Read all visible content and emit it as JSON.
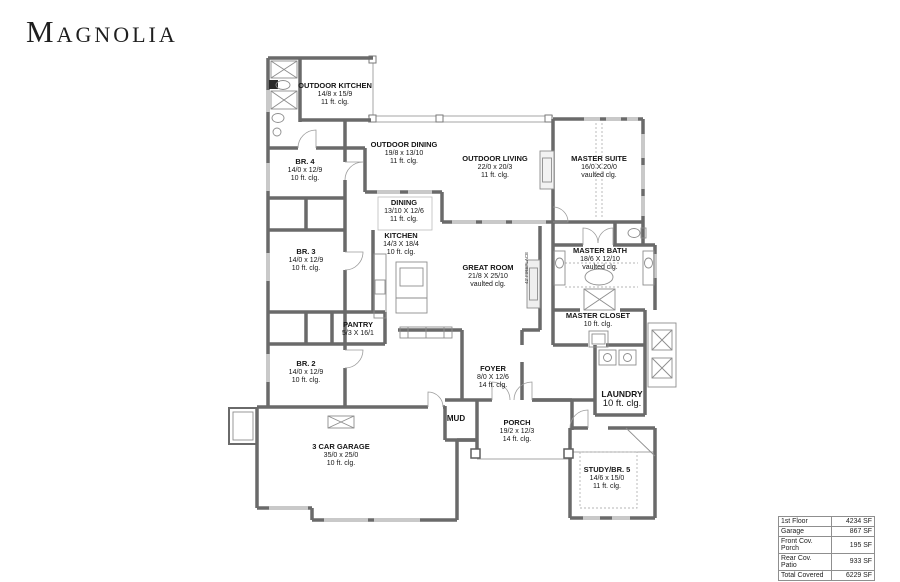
{
  "title": "Magnolia",
  "rooms": {
    "outdoor_kitchen": {
      "name": "OUTDOOR KITCHEN",
      "dims": "14/8 x 15/9",
      "ceiling": "11 ft. clg."
    },
    "outdoor_dining": {
      "name": "OUTDOOR DINING",
      "dims": "19/8 x 13/10",
      "ceiling": "11 ft. clg."
    },
    "outdoor_living": {
      "name": "OUTDOOR LIVING",
      "dims": "22/0 x 20/3",
      "ceiling": "11 ft. clg."
    },
    "master_suite": {
      "name": "MASTER SUITE",
      "dims": "16/0 X 20/0",
      "ceiling": "vaulted clg."
    },
    "br4": {
      "name": "BR. 4",
      "dims": "14/0 x 12/9",
      "ceiling": "10 ft. clg."
    },
    "dining": {
      "name": "DINING",
      "dims": "13/10 X 12/6",
      "ceiling": "11 ft. clg."
    },
    "kitchen": {
      "name": "KITCHEN",
      "dims": "14/3 X 18/4",
      "ceiling": "10 ft. clg."
    },
    "br3": {
      "name": "BR. 3",
      "dims": "14/0 x 12/9",
      "ceiling": "10 ft. clg."
    },
    "great_room": {
      "name": "GREAT ROOM",
      "dims": "21/8 X 25/10",
      "ceiling": "vaulted clg."
    },
    "master_bath": {
      "name": "MASTER BATH",
      "dims": "18/6 X 12/10",
      "ceiling": "vaulted clg."
    },
    "master_closet": {
      "name": "MASTER CLOSET",
      "ceiling": "10 ft. clg."
    },
    "pantry": {
      "name": "PANTRY",
      "dims": "5/3 X 16/1"
    },
    "br2": {
      "name": "BR. 2",
      "dims": "14/0 x 12/9",
      "ceiling": "10 ft. clg."
    },
    "foyer": {
      "name": "FOYER",
      "dims": "8/0 X 12/6",
      "ceiling": "14 ft. clg."
    },
    "laundry": {
      "name": "LAUNDRY",
      "ceiling": "10 ft. clg."
    },
    "mud": {
      "name": "MUD"
    },
    "porch": {
      "name": "PORCH",
      "dims": "19/2 x 12/3",
      "ceiling": "14 ft. clg."
    },
    "garage": {
      "name": "3 CAR GARAGE",
      "dims": "35/0 x 25/0",
      "ceiling": "10 ft. clg."
    },
    "study": {
      "name": "STUDY/BR. 5",
      "dims": "14/6 x 15/0",
      "ceiling": "11 ft. clg."
    }
  },
  "fireplace_label": "42' FIREPLACE",
  "area_table": {
    "rows": [
      {
        "label": "1st Floor",
        "value": "4234 SF"
      },
      {
        "label": "Garage",
        "value": "867 SF"
      },
      {
        "label": "Front Cov. Porch",
        "value": "195 SF"
      },
      {
        "label": "Rear Cov. Patio",
        "value": "933 SF"
      },
      {
        "label": "Total Covered",
        "value": "6229 SF"
      }
    ]
  },
  "colors": {
    "wall": "#6a6a6a",
    "window": "#c9c9c9",
    "thin_line": "#a6a6a6",
    "text": "#1a1a1a"
  }
}
